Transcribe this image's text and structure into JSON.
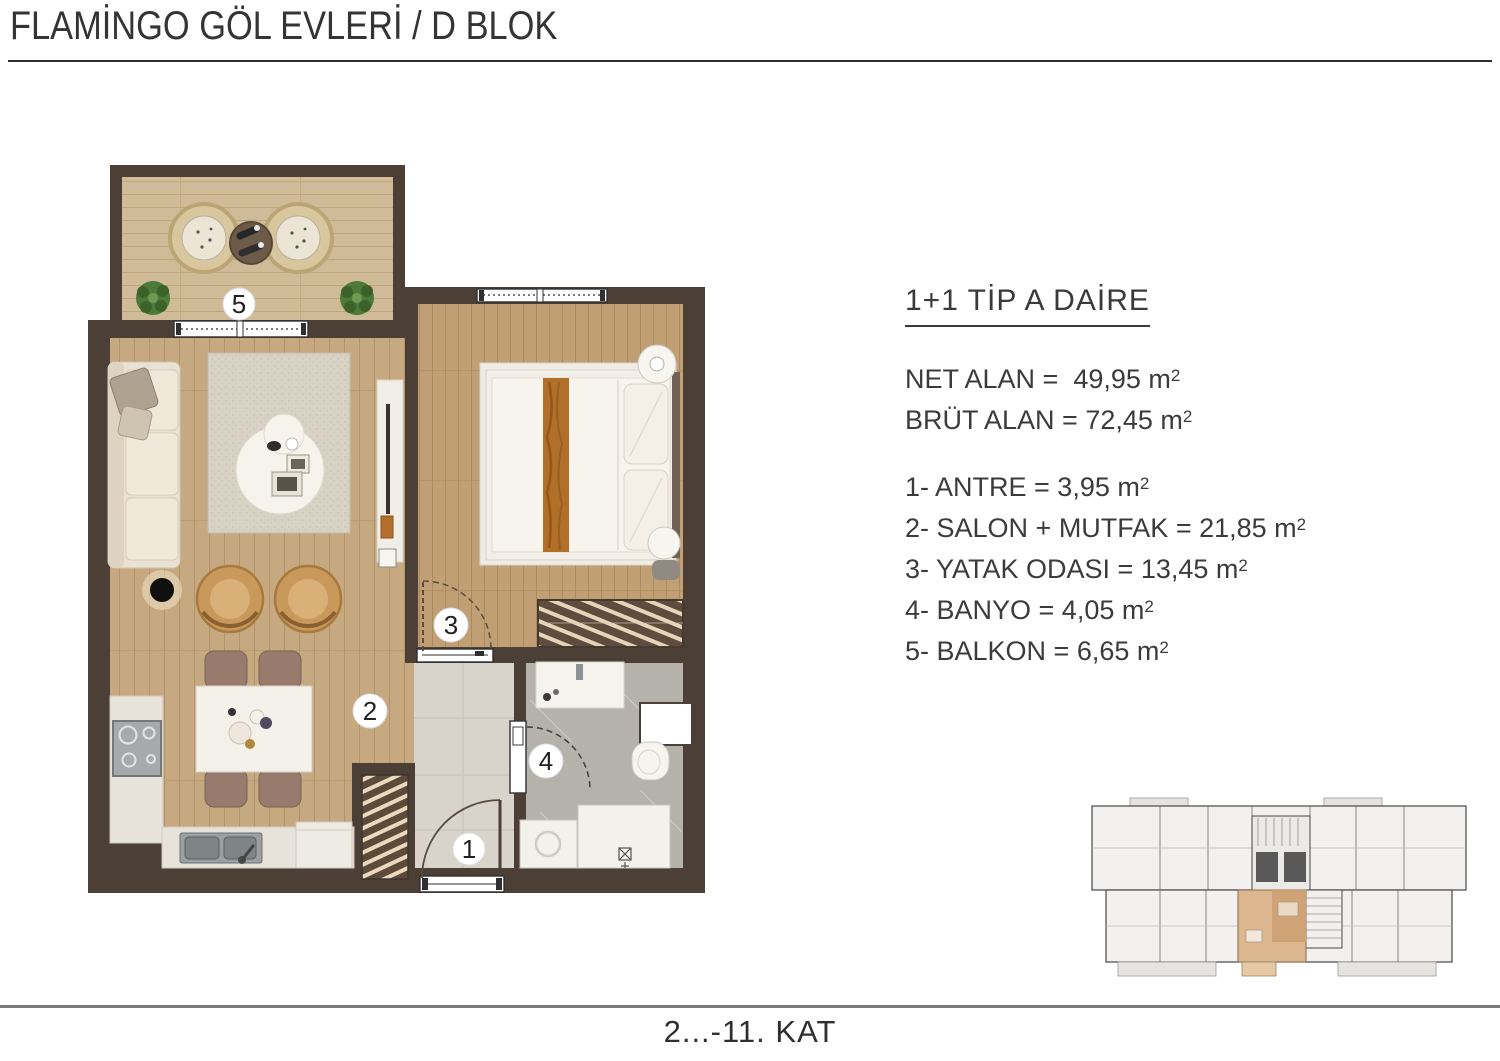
{
  "header": {
    "title": "FLAMİNGO GÖL EVLERİ / D BLOK"
  },
  "info": {
    "unit_title": "1+1 TİP A DAİRE",
    "areas": [
      {
        "text": "NET ALAN =  49,95 m",
        "sup": "2"
      },
      {
        "text": "BRÜT ALAN = 72,45 m",
        "sup": "2"
      }
    ],
    "rooms": [
      {
        "text": "1- ANTRE = 3,95 m",
        "sup": "2"
      },
      {
        "text": "2- SALON + MUTFAK = 21,85 m",
        "sup": "2"
      },
      {
        "text": "3- YATAK ODASI = 13,45 m",
        "sup": "2"
      },
      {
        "text": "4- BANYO = 4,05 m",
        "sup": "2"
      },
      {
        "text": "5- BALKON = 6,65 m",
        "sup": "2"
      }
    ]
  },
  "plan": {
    "badges": [
      {
        "num": "1",
        "room": "antre"
      },
      {
        "num": "2",
        "room": "salon-mutfak"
      },
      {
        "num": "3",
        "room": "yatak-odasi"
      },
      {
        "num": "4",
        "room": "banyo"
      },
      {
        "num": "5",
        "room": "balkon"
      }
    ]
  },
  "footer": {
    "floors": "2...-11. KAT"
  },
  "colors": {
    "wall": "#4b3f36",
    "wood_living": "#c6a980",
    "wood_bedroom": "#c09f74",
    "wood_balcony": "#d0bb98",
    "marble_corridor": "#d8d4cb",
    "bath_floor": "#b5b1ab",
    "keyplan_highlight": "#dcb68f",
    "rule_dark": "#2e2e2e",
    "rule_gray": "#7b7b7b"
  }
}
